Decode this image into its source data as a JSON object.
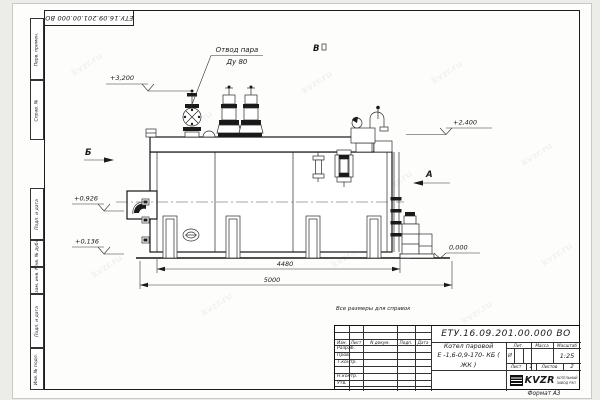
{
  "sheet": {
    "top_stamp": "ЕТУ.16.09.201.00.000  ВО",
    "note": "Все размеры для справок",
    "format_label": "Формат  А3",
    "margin": {
      "perv_primen": "Перв. примен.",
      "sprav_no": "Справ. №",
      "podp_data_1": "Подп. и дата",
      "inv_dubl": "Инв. № дубл.",
      "vzam_inv": "Взам. инв. №",
      "podp_data_2": "Подп. и дата",
      "inv_podl": "Инв. № подл."
    }
  },
  "drawing": {
    "callout": {
      "line1": "Отвод пара",
      "line2": "Ду 80"
    },
    "views": {
      "left": "Б",
      "right": "А",
      "top": "В"
    },
    "elevations": {
      "e_3200": "+3,200",
      "e_2400": "+2,400",
      "e_0926": "+0,926",
      "e_0136": "+0,136",
      "e_0000": "0,000"
    },
    "dims": {
      "width_inner": "4480",
      "width_total": "5000"
    }
  },
  "title_block": {
    "doc_number": "ЕТУ.16.09.201.00.000  ВО",
    "product_name_1": "Котел паровой",
    "product_name_2": "Е -1,6-0,9-170- КБ ( ЖК )",
    "cols": {
      "izm": "Изм.",
      "list": "Лист",
      "doc": "N докум.",
      "podp": "Подп.",
      "data": "Дата"
    },
    "rows": {
      "razrab": "Разраб.",
      "prov": "Пров.",
      "tkontr": "Т.контр.",
      "nkontr": "Н.контр.",
      "utv": "Утв."
    },
    "lit": {
      "label": "Лит.",
      "value": "И"
    },
    "massa_label": "Масса",
    "masshtab_label": "Масштаб",
    "scale": "1:25",
    "sheet_info": {
      "list_label": "Лист",
      "list_value": "1",
      "listov_label": "Листов",
      "listov_value": "2"
    },
    "logo": {
      "name": "KVZR",
      "sub1": "КОТЕЛЬНЫЙ",
      "sub2": "ЗАВОД РЭП"
    }
  },
  "watermark": "kvzr.ru"
}
